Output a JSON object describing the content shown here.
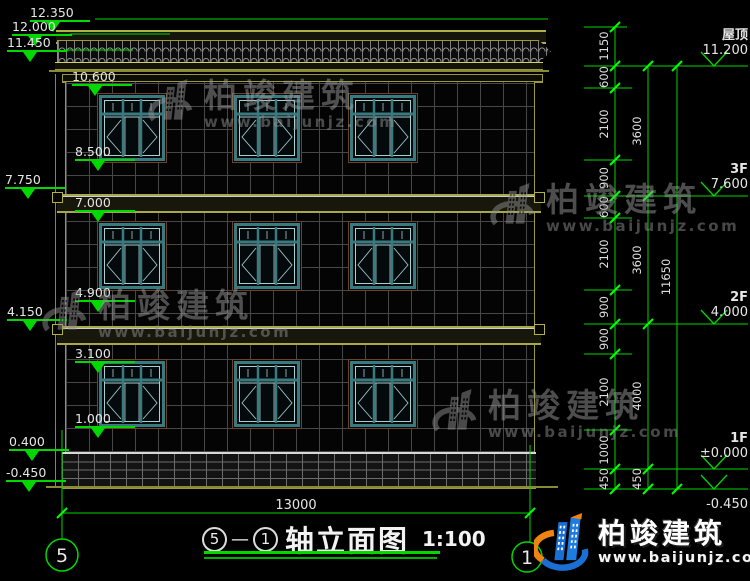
{
  "drawing": {
    "left_levels": [
      "12.350",
      "12.000",
      "11.450",
      "10.600",
      "8.500",
      "7.750",
      "7.000",
      "4.900",
      "4.150",
      "3.100",
      "1.000",
      "0.400",
      "-0.450"
    ],
    "dim_chain": [
      "1150",
      "600",
      "2100",
      "900",
      "600",
      "2100",
      "900",
      "900",
      "2100",
      "1000",
      "450"
    ],
    "floor_chain": [
      "3600",
      "3600",
      "4000",
      "450"
    ],
    "total_height": "11650",
    "levels_right": [
      {
        "label": "屋顶",
        "value": "11.200"
      },
      {
        "label": "3F",
        "value": "7.600"
      },
      {
        "label": "2F",
        "value": "4.000"
      },
      {
        "label": "1F",
        "value": "±0.000"
      },
      {
        "label": "",
        "value": "-0.450"
      }
    ],
    "width_dim": "13000",
    "axis_left": "5",
    "axis_right": "1",
    "caption": {
      "axis_start": "5",
      "dash": "—",
      "axis_end": "1",
      "text": "轴立面图",
      "scale": "1:100"
    }
  },
  "watermark": {
    "brand": "柏竣建筑",
    "site": "www.baijunjz.com"
  },
  "footer_logo": {
    "brand": "柏竣建筑",
    "site": "www.baijunjz.com"
  },
  "colors": {
    "dim_green": "#00d800",
    "trim_olive": "#9a9a3c",
    "window_teal": "#3a7a7e",
    "brand_blue": "#1a6fd4",
    "brand_orange": "#f08411"
  }
}
